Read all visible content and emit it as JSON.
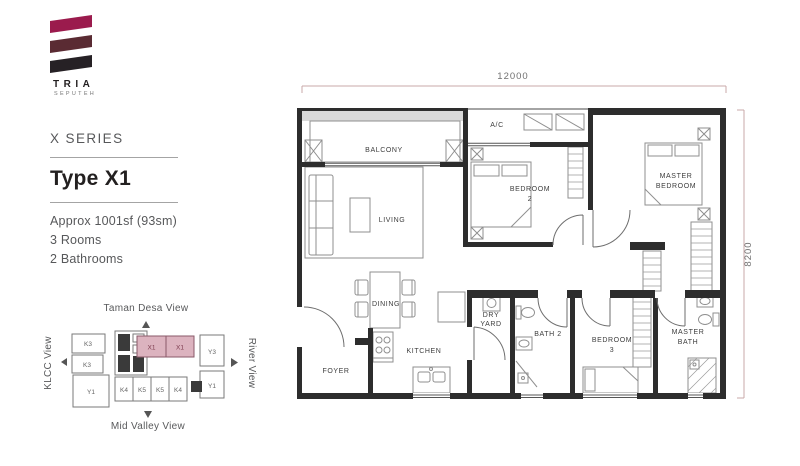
{
  "brand": {
    "name": "TRIA",
    "subtitle": "SEPUTEH"
  },
  "panel": {
    "series": "X SERIES",
    "type_title": "Type X1",
    "details": [
      "Approx 1001sf (93sm)",
      "3 Rooms",
      "2 Bathrooms"
    ]
  },
  "key_plan": {
    "views": {
      "top": "Taman Desa View",
      "bottom": "Mid Valley View",
      "left": "KLCC View",
      "right": "River View"
    },
    "units": {
      "k3a": "K3",
      "k3b": "K3",
      "y1_left": "Y1",
      "x1a": "X1",
      "x1b": "X1",
      "y3": "Y3",
      "y1_right": "Y1",
      "k4a": "K4",
      "k5a": "K5",
      "k5b": "K5",
      "k4b": "K4"
    }
  },
  "floor_plan": {
    "dim_width": "12000",
    "dim_height": "8200",
    "rooms": {
      "balcony": "BALCONY",
      "ac": "A/C",
      "living": "LIVING",
      "bedroom2": [
        "BEDROOM",
        "2"
      ],
      "master_bedroom": [
        "MASTER",
        "BEDROOM"
      ],
      "dining": "DINING",
      "dry_yard": [
        "DRY",
        "YARD"
      ],
      "bath2": "BATH 2",
      "bedroom3": [
        "BEDROOM",
        "3"
      ],
      "master_bath": [
        "MASTER",
        "BATH"
      ],
      "kitchen": "KITCHEN",
      "foyer": "FOYER"
    }
  },
  "colors": {
    "logo_top": "#9B1B4D",
    "logo_middle": "#5A2B33",
    "logo_bottom": "#262125",
    "unit_highlight": "#DCB3BF",
    "dimension_line": "#C9A8A8"
  }
}
